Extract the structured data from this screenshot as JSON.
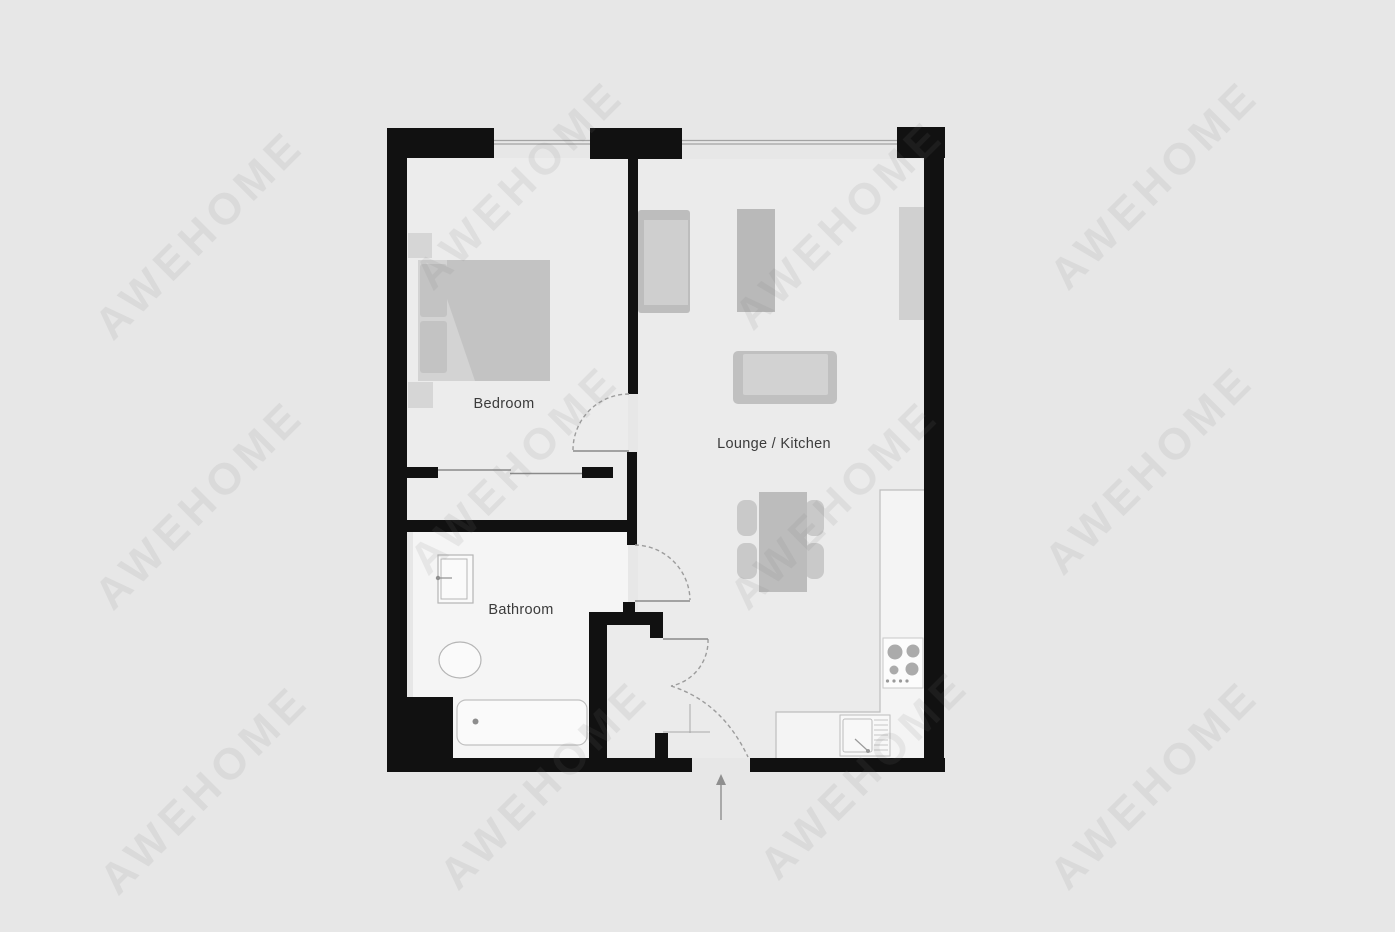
{
  "page": {
    "background": "#e7e7e7"
  },
  "watermark": {
    "text": "AWEHOME"
  },
  "rooms": {
    "bedroom": {
      "label": "Bedroom"
    },
    "lounge_kitchen": {
      "label": "Lounge / Kitchen"
    },
    "bathroom": {
      "label": "Bathroom"
    }
  },
  "colors": {
    "wall": "#111111",
    "room_floor": "#ececec",
    "wet_room_floor": "#f5f5f5",
    "counter": "#f4f4f4",
    "furniture_light": "#d3d3d3",
    "furniture_mid": "#c3c3c3",
    "door_line": "#9c9c9c",
    "label_text": "#3b3b3b"
  },
  "fixtures": {
    "bedroom": [
      "bed",
      "pillow",
      "pillow",
      "duvet",
      "nightstand",
      "nightstand",
      "wardrobe-sliding-door"
    ],
    "lounge_kitchen": [
      "armchair",
      "tv-unit",
      "sideboard",
      "sofa",
      "dining-table",
      "dining-chair",
      "dining-chair",
      "dining-chair",
      "dining-chair",
      "kitchen-counter",
      "hob",
      "kitchen-sink"
    ],
    "bathroom": [
      "washbasin",
      "toilet",
      "bathtub"
    ],
    "hall": [
      "storage-closet",
      "entrance-arrow"
    ]
  },
  "doors": [
    "bedroom-door",
    "bathroom-door",
    "closet-door",
    "entrance-door"
  ],
  "windows": [
    "bedroom-window",
    "lounge-window"
  ]
}
